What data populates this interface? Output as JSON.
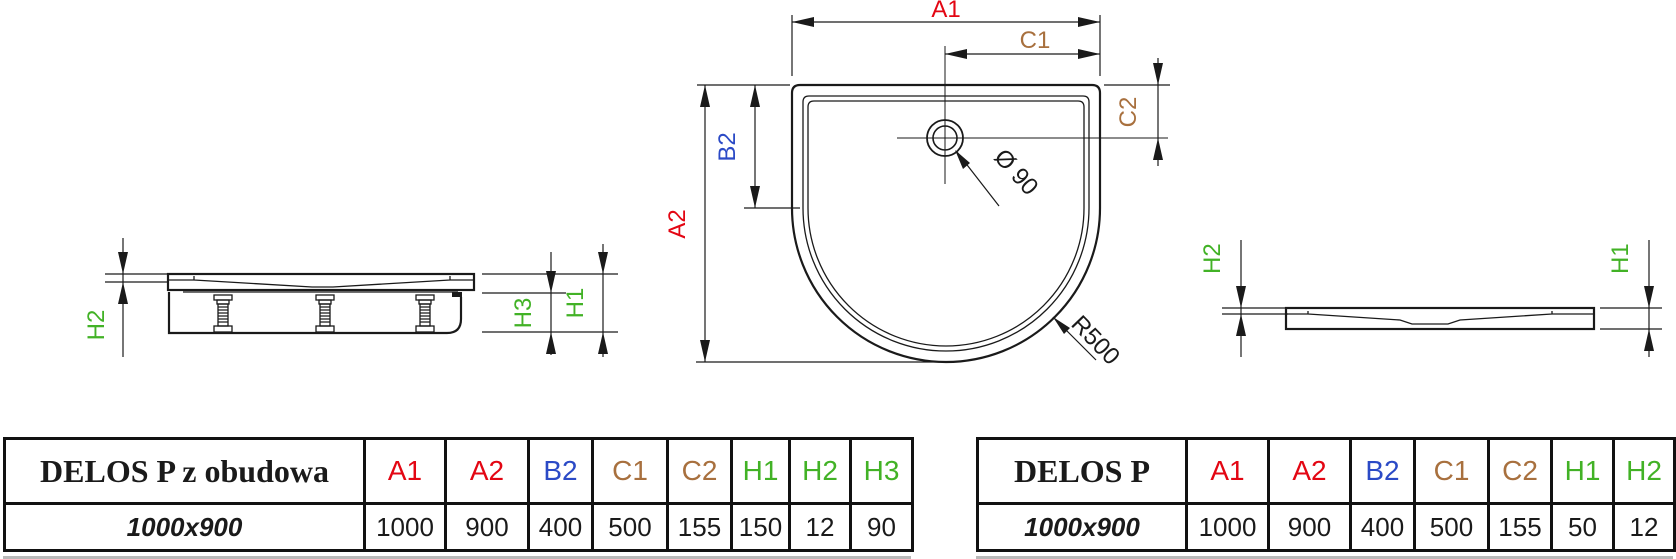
{
  "colors": {
    "red": "#e30613",
    "blue": "#2b4ac6",
    "brown": "#a8703e",
    "green": "#42b226",
    "line": "#1a1a1a"
  },
  "drawings": {
    "side_view_with_panel": {
      "description": "side view of tray with support panel and adjustable feet",
      "labels": {
        "h2": "H2",
        "h3": "H3",
        "h1": "H1"
      }
    },
    "top_view": {
      "description": "top view of half-round tray",
      "labels": {
        "a1": "A1",
        "c1": "C1",
        "c2": "C2",
        "b2": "B2",
        "a2": "A2",
        "diameter": "Ø 90",
        "radius": "R500"
      }
    },
    "side_view_tray": {
      "description": "side view of tray only",
      "labels": {
        "h2": "H2",
        "h1": "H1"
      }
    }
  },
  "tables": [
    {
      "name": "DELOS P z obudowa",
      "columns": [
        {
          "label": "A1",
          "color": "#e30613"
        },
        {
          "label": "A2",
          "color": "#e30613"
        },
        {
          "label": "B2",
          "color": "#2b4ac6"
        },
        {
          "label": "C1",
          "color": "#a8703e"
        },
        {
          "label": "C2",
          "color": "#a8703e"
        },
        {
          "label": "H1",
          "color": "#42b226"
        },
        {
          "label": "H2",
          "color": "#42b226"
        },
        {
          "label": "H3",
          "color": "#42b226"
        }
      ],
      "rows": [
        {
          "size": "1000x900",
          "values": [
            "1000",
            "900",
            "400",
            "500",
            "155",
            "150",
            "12",
            "90"
          ]
        }
      ]
    },
    {
      "name": "DELOS P",
      "columns": [
        {
          "label": "A1",
          "color": "#e30613"
        },
        {
          "label": "A2",
          "color": "#e30613"
        },
        {
          "label": "B2",
          "color": "#2b4ac6"
        },
        {
          "label": "C1",
          "color": "#a8703e"
        },
        {
          "label": "C2",
          "color": "#a8703e"
        },
        {
          "label": "H1",
          "color": "#42b226"
        },
        {
          "label": "H2",
          "color": "#42b226"
        }
      ],
      "rows": [
        {
          "size": "1000x900",
          "values": [
            "1000",
            "900",
            "400",
            "500",
            "155",
            "50",
            "12"
          ]
        }
      ]
    }
  ]
}
